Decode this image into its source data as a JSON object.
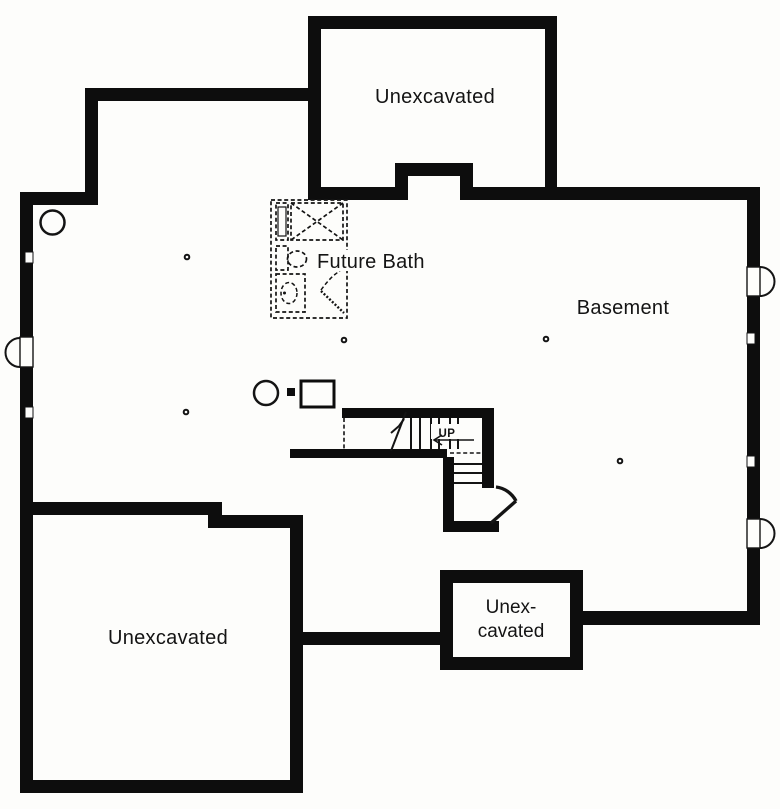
{
  "colors": {
    "wall": "#0d0d0d",
    "line": "#141414",
    "background": "#fdfdfb",
    "text": "#141414"
  },
  "labels": {
    "room_unexcavated_top": "Unexcavated",
    "room_basement": "Basement",
    "room_future_bath": "Future Bath",
    "room_unexcavated_bottom_left": "Unexcavated",
    "room_unexcavated_small_line1": "Unex-",
    "room_unexcavated_small_line2": "cavated",
    "stair_direction": "UP"
  }
}
